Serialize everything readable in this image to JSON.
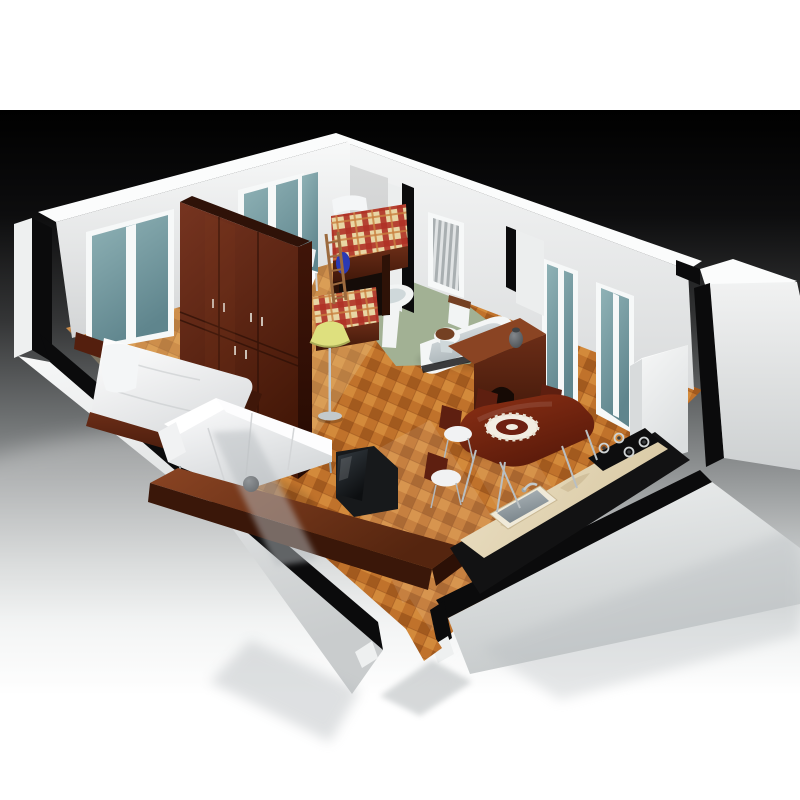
{
  "scene": {
    "type": "3d-apartment-floorplan-cutaway-render",
    "rooms": [
      "bedroom",
      "kids-room",
      "bathroom",
      "hallway",
      "living-room",
      "dining-area",
      "kitchen",
      "entry"
    ],
    "objects": [
      "double-bed",
      "wardrobe",
      "bunk-bed",
      "bunk-ladder",
      "stool",
      "pedestal-sink",
      "toilet",
      "bathtub",
      "sideboard",
      "vase",
      "floor-lamp",
      "sectional-sofa",
      "sphere-vase",
      "tv",
      "tv-cabinet",
      "dining-table",
      "centerpiece-doily",
      "dining-chair",
      "kitchen-counter",
      "kitchen-sink",
      "gas-cooktop",
      "refrigerator",
      "window",
      "curtain-window"
    ]
  },
  "palette": {
    "bg0": "#000000",
    "bg1": "#0d0d0e",
    "bg2": "#343536",
    "bg3": "#6b6e6f",
    "bg4": "#a0a3a4",
    "bg5": "#ced1d1",
    "bg6": "#eff1f1",
    "bg7": "#ffffff",
    "wallTop": "#fbfcfc",
    "wallL1": "#f8f9f9",
    "wallL2": "#d3d5d6",
    "wallR1": "#f4f5f5",
    "wallR2": "#d9dbdc",
    "far1": "#f1f2f2",
    "far2": "#cdd0d1",
    "fl1": "#f7f8f8",
    "fl2": "#c9cccd",
    "fr1": "#eef0f0",
    "fr2": "#c6cacb",
    "outerSliver": "#eef0f0",
    "partition": "#eceeee",
    "cutBlack": "#0b0b0c",
    "frameWhite": "#f6f8f8",
    "glass1": "#8fb2b6",
    "glass2": "#5f858d",
    "stripeA": "#e0e3e4",
    "stripeB": "#a9afb1",
    "floorBase": "#c0722b",
    "floorDark": "#a25a1e",
    "floorLight": "#d38a3b",
    "floorLine": "#8f4a18",
    "bedroomTint": "#e9c98e",
    "bathFloor": "#a2b194",
    "wood1": "#6b2d17",
    "wood2": "#3f1709",
    "wardF1": "#763420",
    "wardF2": "#451808",
    "wardS1": "#401508",
    "wardS2": "#240a03",
    "woodTop": "#2f1208",
    "cab1": "#8a4423",
    "cab2": "#55250f",
    "cabFront": "#3a1709",
    "cabEnd": "#2c1006",
    "plaidBase": "#e8d6a4",
    "plaidRed": "#b03226",
    "plaidAccent": "#c9803f",
    "mattress1": "#ffffff",
    "mattress2": "#d9dbdd",
    "pillow": "#f4f6f7",
    "sofa1": "#fdfdfe",
    "sofa2": "#d4d7d9",
    "sofaBack": "#ffffff",
    "lampShade": "#dee07e",
    "lampRim": "#a9ab57",
    "chrome": "#c3c9cc",
    "steel": "#9aa4a8",
    "counterBlack": "#121213",
    "marble1": "#ece1c6",
    "marble2": "#d9c9a4",
    "marbleVein": "#c6b38c",
    "sinkRim": "#f0ead9",
    "basin1": "#b3bbbf",
    "basin2": "#79848a",
    "cooktop": "#0d0d0e",
    "burnerRing": "#cfd3d4",
    "burnerCenter": "#3a3d3f",
    "table1": "#8c3015",
    "table2": "#5a1a0a",
    "chairWood": "#5e1f10",
    "chairSeat": "#f1f2f3",
    "doily": "#f2ede2",
    "doilyInner": "#6e2012",
    "tub": "#f4f6f6",
    "tubIn1": "#e3e8ea",
    "tubIn2": "#a9b3b7",
    "tubEdge": "#1a1a1b",
    "porcelain": "#f2f4f4",
    "porcelainShade": "#cfd8da",
    "toiletSeat": "#744023",
    "fridge1": "#f6f7f7",
    "fridge2": "#dbdedf",
    "fridgeSide": "#d8dbdc",
    "fridgeTop": "#fafbfb",
    "tv1": "#343b41",
    "tv2": "#0d0f11",
    "tvBody": "#17191b",
    "sphere1": "#6a6e72",
    "sphere2": "#17191b",
    "vase1": "#83878c",
    "vase2": "#3f4347",
    "blueBag": "#2a3ab4",
    "ladder": "#9c6a3e",
    "headboard": "#541f0e",
    "refl": "#b7bcbf",
    "reflDark": "#9aa0a3",
    "archDark": "#160a05",
    "underBunk": "#150c08",
    "postWood": "#2e1207",
    "shadow": "#000000"
  }
}
